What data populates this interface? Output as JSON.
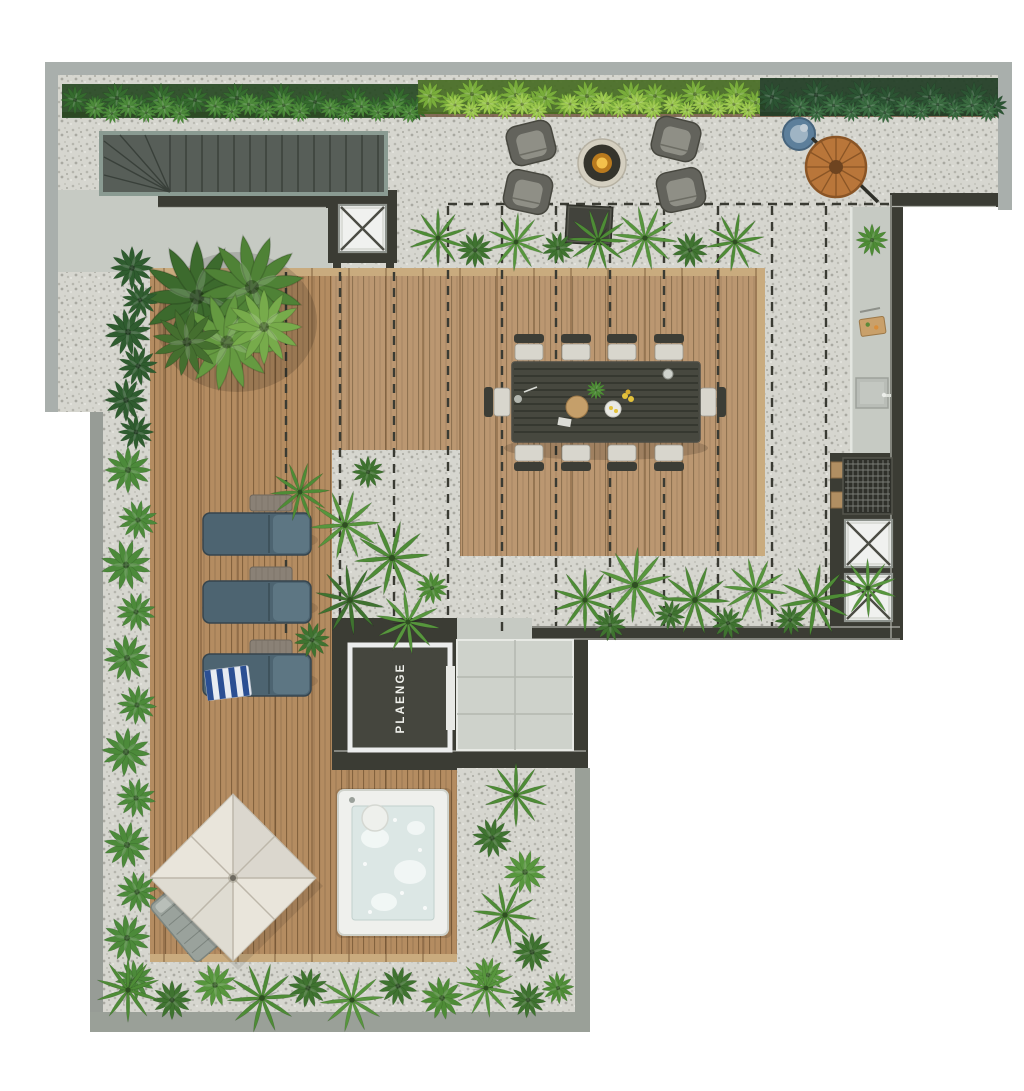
{
  "labels": {
    "elevator_brand": "PLAENGE"
  },
  "palette": {
    "background": "#ffffff",
    "outer_wall": "#a9afac",
    "dark_wall": "#3b3c34",
    "gravel": "#d6d6cf",
    "concrete": "#c6cac3",
    "deck_wood": "#b48c61",
    "tile_floor": "#ced2cb",
    "stair_frame": "#8a9b92",
    "hedge_dark": "#2e5c2f",
    "hedge_bright": "#7fb33c",
    "foliage_green": "#4e8c36",
    "water_blue": "#dce7e5",
    "lounger_blue": "#4d6471",
    "fire_glow": "#f4c14c",
    "cocoon_wood": "#b9763a",
    "daybed_blue": "#5d7f9b",
    "towel_blue": "#2b4f93",
    "parasol_canvas": "#e9e5db",
    "cushion_light": "#d8d6cd"
  },
  "inventory": {
    "dining_chairs": 10,
    "lounge_armchairs": 4,
    "sun_loungers": 3,
    "roof_hatches": 3,
    "fire_pits": 1,
    "hot_tubs": 1,
    "parasols": 1,
    "hanging_chairs": 1,
    "round_daybeds": 1
  }
}
